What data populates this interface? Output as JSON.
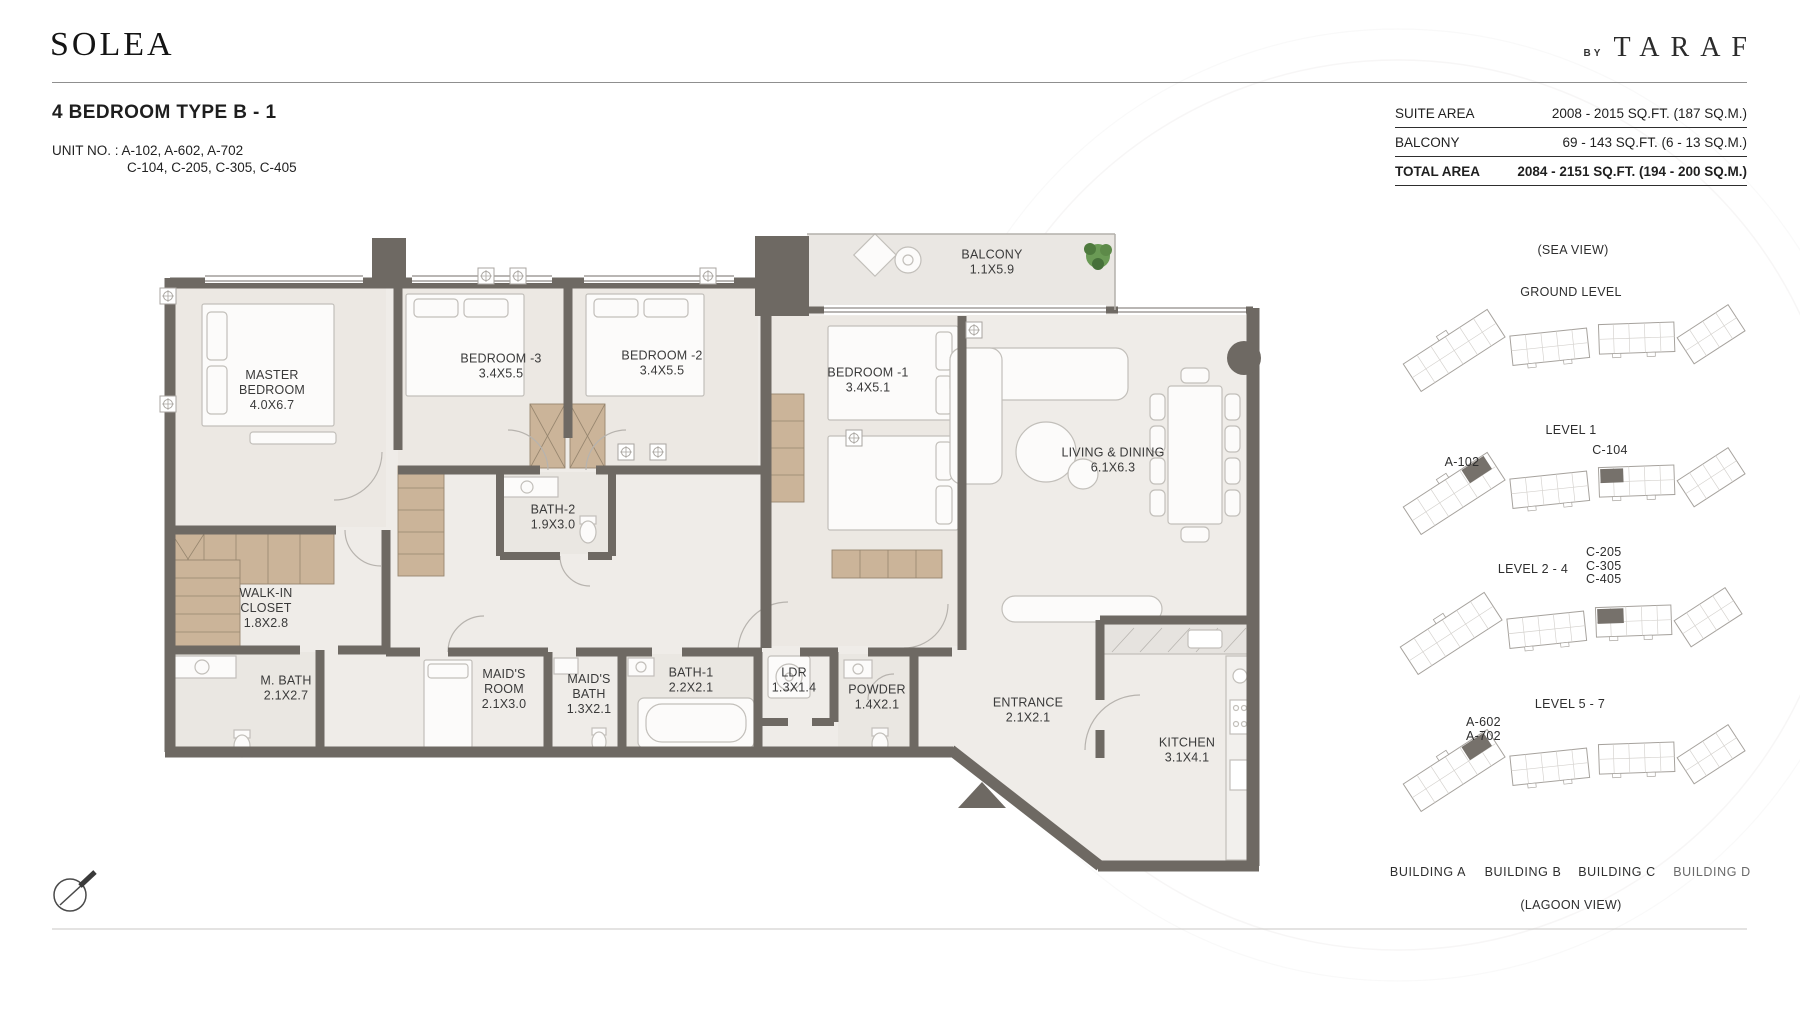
{
  "brand": {
    "logo": "SOLEA",
    "by_label": "BY",
    "name": "TARAF"
  },
  "header": {
    "title": "4 BEDROOM TYPE B - 1",
    "unit_label": "UNIT NO. :",
    "unit_line1": "A-102, A-602, A-702",
    "unit_line2": "C-104, C-205, C-305, C-405"
  },
  "area_table": {
    "rows": [
      {
        "label": "SUITE AREA",
        "value": "2008 - 2015 SQ.FT. (187 SQ.M.)"
      },
      {
        "label": "BALCONY",
        "value": "69 - 143 SQ.FT. (6 - 13 SQ.M.)"
      },
      {
        "label": "TOTAL AREA",
        "value": "2084 - 2151 SQ.FT. (194 - 200 SQ.M.)"
      }
    ]
  },
  "floor_plan": {
    "rooms": [
      {
        "name": "MASTER BEDROOM",
        "dims": "4.0X6.7"
      },
      {
        "name": "BEDROOM -3",
        "dims": "3.4X5.5"
      },
      {
        "name": "BEDROOM -2",
        "dims": "3.4X5.5"
      },
      {
        "name": "BEDROOM -1",
        "dims": "3.4X5.1"
      },
      {
        "name": "BALCONY",
        "dims": "1.1X5.9"
      },
      {
        "name": "LIVING & DINING",
        "dims": "6.1X6.3"
      },
      {
        "name": "BATH-2",
        "dims": "1.9X3.0"
      },
      {
        "name": "WALK-IN CLOSET",
        "dims": "1.8X2.8"
      },
      {
        "name": "M. BATH",
        "dims": "2.1X2.7"
      },
      {
        "name": "MAID'S ROOM",
        "dims": "2.1X3.0"
      },
      {
        "name": "MAID'S BATH",
        "dims": "1.3X2.1"
      },
      {
        "name": "BATH-1",
        "dims": "2.2X2.1"
      },
      {
        "name": "LDR",
        "dims": "1.3X1.4"
      },
      {
        "name": "POWDER",
        "dims": "1.4X2.1"
      },
      {
        "name": "ENTRANCE",
        "dims": "2.1X2.1"
      },
      {
        "name": "KITCHEN",
        "dims": "3.1X4.1"
      }
    ],
    "icons": {
      "compass": "compass-north-indicator",
      "entrance_arrow": "entrance-arrow",
      "plant": "balcony-plant"
    }
  },
  "key_plan": {
    "sea_view_label": "(SEA VIEW)",
    "lagoon_view_label": "(LAGOON VIEW)",
    "levels": [
      {
        "label": "GROUND LEVEL",
        "units": []
      },
      {
        "label": "LEVEL 1",
        "units": [
          "A-102",
          "C-104"
        ]
      },
      {
        "label": "LEVEL 2 - 4",
        "units": [
          "C-205",
          "C-305",
          "C-405"
        ]
      },
      {
        "label": "LEVEL 5 - 7",
        "units": [
          "A-602",
          "A-702"
        ]
      }
    ],
    "buildings": [
      "BUILDING A",
      "BUILDING B",
      "BUILDING C",
      "BUILDING D"
    ]
  },
  "colors": {
    "wall": "#6e6963",
    "floor": "#efece8",
    "bedroom_floor": "#ece8e3",
    "balcony_floor": "#eae7e3",
    "wardrobe": "#cbb499",
    "highlight_unit": "#76716b",
    "plant": "#6a9a55",
    "text": "#3b3b3b"
  }
}
